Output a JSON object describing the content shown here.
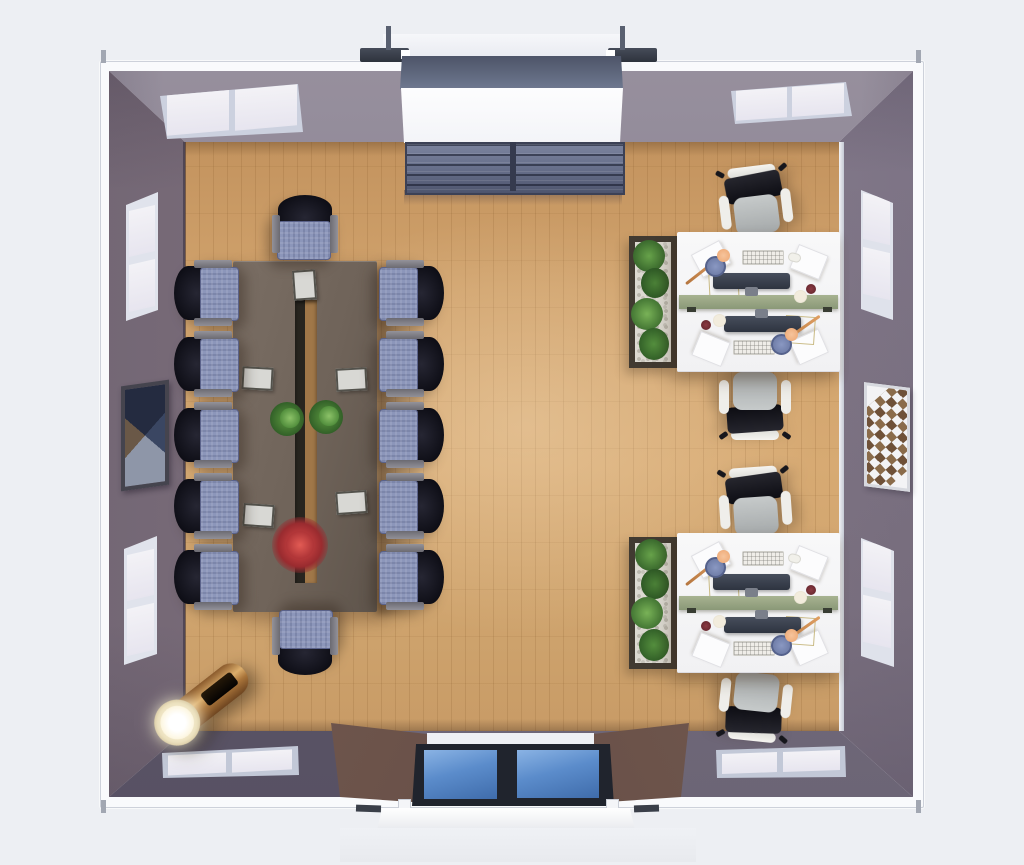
{
  "scene": {
    "type": "3d-rendered-top-down-floor-plan",
    "room": "office meeting room with conference area and two workstations",
    "view": "overhead orthographic render, no visible text",
    "background_color": "#edeff3"
  },
  "architecture": {
    "floor": {
      "material": "light-oak-plank",
      "color": "#cda26c"
    },
    "walls": {
      "inner_face_color": "#857a8a",
      "roof_trim_color": "#f9fafc",
      "door_flank_color": "#6d564e"
    },
    "windows": [
      {
        "wall": "top",
        "position": "left",
        "panes": 2
      },
      {
        "wall": "top",
        "position": "right",
        "panes": 2
      },
      {
        "wall": "left",
        "position": "upper",
        "panes": 2
      },
      {
        "wall": "left",
        "position": "lower",
        "panes": 2
      },
      {
        "wall": "right",
        "position": "upper",
        "panes": 2
      },
      {
        "wall": "right",
        "position": "lower",
        "panes": 2
      },
      {
        "wall": "bottom",
        "position": "left",
        "panes": 2
      },
      {
        "wall": "bottom",
        "position": "right",
        "panes": 2
      }
    ],
    "door": {
      "wall": "bottom",
      "type": "double-glass",
      "glass_color": "#4d7fc2",
      "frame_color": "#20242d",
      "white_step": true
    },
    "top_entrance": {
      "canopy_color": "#f6f7fa",
      "bracket_color": "#383d49",
      "slope_color": "#5a6276",
      "opening_color": "#fbfcfe"
    }
  },
  "furniture": {
    "conference_table": {
      "color": "#6f6359",
      "center_channel": true,
      "channel_wood_color": "#a07748",
      "chairs_total": 12,
      "chairs_left": 5,
      "chairs_right": 5,
      "chairs_head": 1,
      "chairs_foot": 1,
      "chair_seat_color": "#8c96ba",
      "chair_back_color": "#12121a",
      "armrest_color": "#7c7b82",
      "tabletop_items": {
        "notepads": 5,
        "green_plants": 2,
        "red_plant": 1
      }
    },
    "bookshelf": {
      "location": "top-center against wall",
      "color": "#656d88",
      "sections": 2,
      "shelves_per_section": 4
    },
    "workstations": [
      {
        "location": "upper-right",
        "desk_color": "#f7f7f8",
        "divider_color": "#97a585",
        "chairs": 2,
        "planter": {
          "frame_color": "#413a31",
          "pebble_color": "#dcd9d1",
          "plant_colors": [
            "#56913f",
            "#3c6e2e",
            "#6da24c"
          ]
        },
        "desk_items": {
          "monitors": 2,
          "keyboards": 2,
          "papers": 4,
          "desk_lamps": 2,
          "mugs": 2,
          "mice": 2,
          "trays": 2
        }
      },
      {
        "location": "lower-right",
        "desk_color": "#f7f7f8",
        "divider_color": "#97a585",
        "chairs": 2,
        "planter": {
          "frame_color": "#413a31",
          "pebble_color": "#dcd9d1",
          "plant_colors": [
            "#56913f",
            "#3c6e2e",
            "#6da24c"
          ]
        },
        "desk_items": {
          "monitors": 2,
          "keyboards": 2,
          "papers": 4,
          "desk_lamps": 2,
          "mugs": 2,
          "mice": 2,
          "trays": 2
        }
      }
    ],
    "task_chair": {
      "seat_color": "#b6baba",
      "back_color": "#17171d",
      "frame_color": "#efeeea"
    },
    "wall_art": [
      {
        "wall": "left",
        "pattern": "triangle-bowtie",
        "frame_color": "#45444e"
      },
      {
        "wall": "right",
        "pattern": "diamond-grid",
        "frame_color": "#d7d9df",
        "diamond_color": "#6f5138"
      }
    ],
    "floor_lamp": {
      "style": "cylindrical-flashlight",
      "body_color": "#a9743a",
      "lens_glow": "#fffdf0",
      "location": "bottom-left corner"
    }
  }
}
